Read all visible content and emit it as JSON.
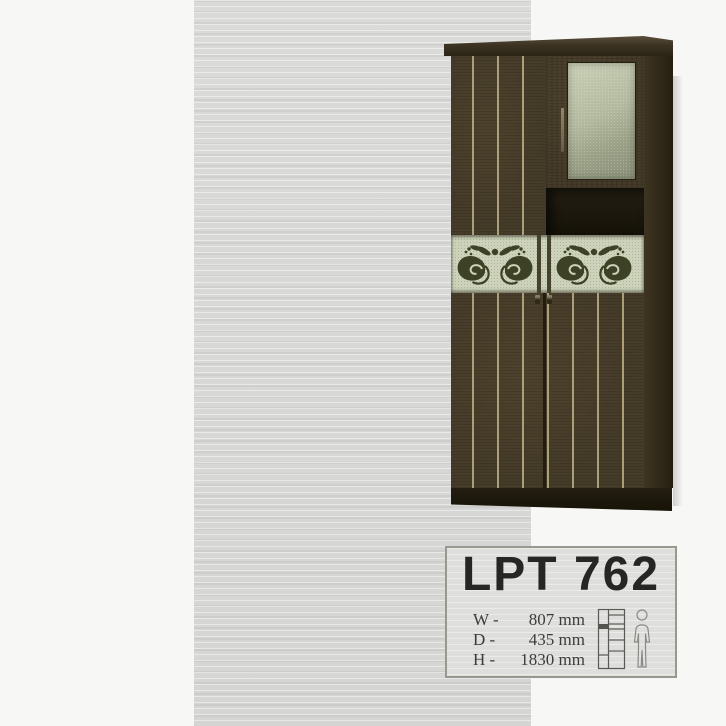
{
  "product": {
    "code": "LPT 762",
    "dimensions": [
      {
        "label": "W -",
        "value": "807 mm"
      },
      {
        "label": "D -",
        "value": "435 mm"
      },
      {
        "label": "H -",
        "value": "1830 mm"
      }
    ]
  },
  "photo_colors": {
    "wood": "#453b29",
    "stripe": "#c5b88d",
    "glass": "#b3baa0",
    "ornament_band": "#cdd2ba",
    "ornament_motif": "#3d4126",
    "scan_background": "#d8d8d6"
  },
  "icons": {
    "scale_diagram": "wardrobe-shelves-diagram-icon",
    "human": "human-figure-icon",
    "ornament": "paisley-ornament"
  }
}
